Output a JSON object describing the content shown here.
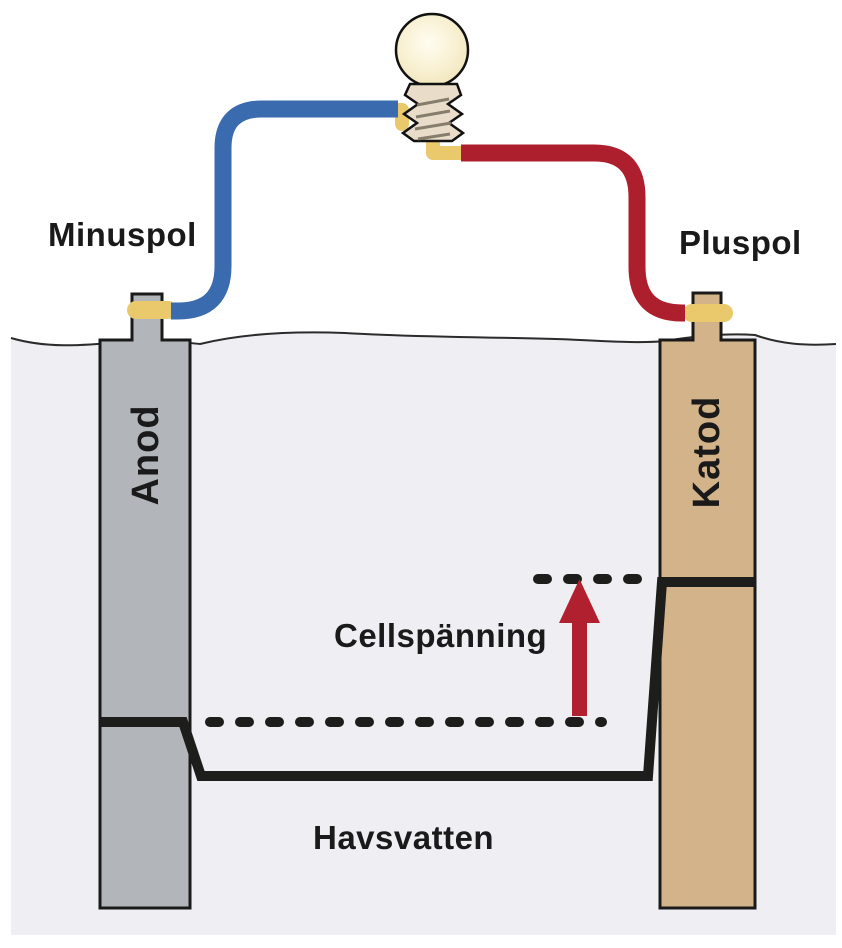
{
  "labels": {
    "minus_pole": "Minuspol",
    "plus_pole": "Pluspol",
    "anode": "Anod",
    "cathode": "Katod",
    "cell_voltage": "Cellspänning",
    "seawater": "Havsvatten"
  },
  "icons": {
    "light_bulb": "light-bulb-icon",
    "voltage_arrow": "up-arrow-icon"
  },
  "colors": {
    "water": "#eeeef3",
    "anode_fill": "#b2b6bb",
    "cathode_fill": "#d3b389",
    "wire_negative": "#3a6bae",
    "wire_positive": "#ae1f2d",
    "connector": "#eac96d",
    "arrow": "#b1202e",
    "profile_line": "#1d1d1b",
    "dotted_line": "#1d1d1b",
    "bulb_glass": "#f6edca",
    "bulb_base": "#e9ddc9",
    "bulb_thread": "#867d6d",
    "outline": "#1a1a1a",
    "text": "#1a1a1a"
  }
}
